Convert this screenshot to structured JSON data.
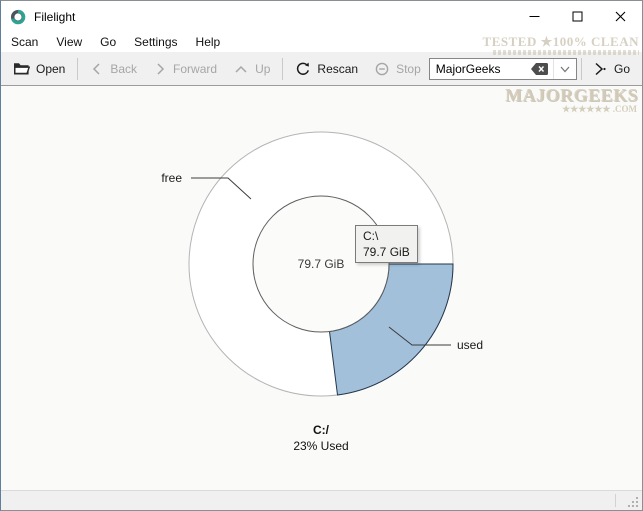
{
  "window": {
    "title": "Filelight"
  },
  "menubar": {
    "items": [
      "Scan",
      "View",
      "Go",
      "Settings",
      "Help"
    ]
  },
  "toolbar": {
    "open_label": "Open",
    "back_label": "Back",
    "forward_label": "Forward",
    "up_label": "Up",
    "rescan_label": "Rescan",
    "stop_label": "Stop",
    "location_value": "MajorGeeks",
    "go_label": "Go"
  },
  "watermark": {
    "tested_line": "TESTED ★100% CLEAN",
    "brand": "MAJORGEEKS",
    "brand_sub": "★★★★★★ .COM"
  },
  "chart_data": {
    "type": "pie",
    "title": "C:/",
    "subtitle": "23% Used",
    "total_label": "79.7 GiB",
    "slices": [
      {
        "label": "used",
        "percent": 23,
        "color": "#a2c0da"
      },
      {
        "label": "free",
        "percent": 77,
        "color": "#ffffff"
      }
    ],
    "tooltip": {
      "path": "C:\\",
      "size": "79.7 GiB"
    }
  }
}
